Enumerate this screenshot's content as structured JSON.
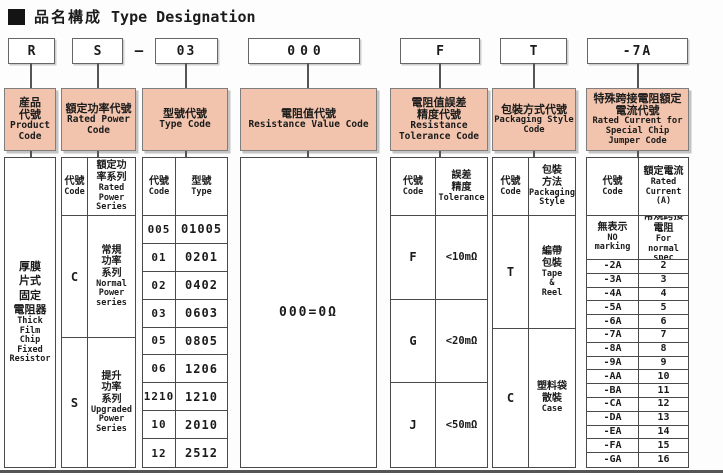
{
  "title": {
    "zh": "品名構成",
    "en": "Type Designation",
    "bullet_icon": "filled-square"
  },
  "codes": {
    "product": "R",
    "power": "S",
    "separator": "—",
    "type": "03",
    "resistance": "000",
    "tolerance": "F",
    "packaging": "T",
    "current": "-7A"
  },
  "headers": [
    {
      "zh": "産品\n代號",
      "en": "Product\nCode"
    },
    {
      "zh": "額定功率代號",
      "en": "Rated Power\nCode"
    },
    {
      "zh": "型號代號",
      "en": "Type Code"
    },
    {
      "zh": "電阻值代號",
      "en": "Resistance Value Code"
    },
    {
      "zh": "電阻值誤差\n精度代號",
      "en": "Resistance\nTolerance Code"
    },
    {
      "zh": "包裝方式代號",
      "en": "Packaging Style\nCode"
    },
    {
      "zh": "特殊跨接電阻額定\n電流代號",
      "en": "Rated Current for\nSpecial Chip\nJumper Code"
    }
  ],
  "product": {
    "body_zh": "厚膜\n片式\n固定\n電阻器",
    "body_en": "Thick\nFilm\nChip\nFixed\nResistor"
  },
  "power": {
    "sub_code_zh": "代號",
    "sub_code_en": "Code",
    "sub_series_zh": "額定功\n率系列",
    "sub_series_en": "Rated\nPower\nSeries",
    "rows": [
      {
        "code": "C",
        "zh": "常規\n功率\n系列",
        "en": "Normal\nPower\nseries"
      },
      {
        "code": "S",
        "zh": "提升\n功率\n系列",
        "en": "Upgraded\nPower\nSeries"
      }
    ]
  },
  "type": {
    "sub_code_zh": "代號",
    "sub_code_en": "Code",
    "sub_type_zh": "型號",
    "sub_type_en": "Type",
    "rows": [
      [
        "005",
        "01005"
      ],
      [
        "01",
        "0201"
      ],
      [
        "02",
        "0402"
      ],
      [
        "03",
        "0603"
      ],
      [
        "05",
        "0805"
      ],
      [
        "06",
        "1206"
      ],
      [
        "1210",
        "1210"
      ],
      [
        "10",
        "2010"
      ],
      [
        "12",
        "2512"
      ]
    ]
  },
  "resistance": {
    "body": "000=0Ω"
  },
  "tolerance": {
    "sub_code_zh": "代號",
    "sub_code_en": "Code",
    "sub_tol_zh": "誤差\n精度",
    "sub_tol_en": "Tolerance",
    "rows": [
      [
        "F",
        "<10mΩ"
      ],
      [
        "G",
        "<20mΩ"
      ],
      [
        "J",
        "<50mΩ"
      ]
    ]
  },
  "packaging": {
    "sub_code_zh": "代號",
    "sub_code_en": "Code",
    "sub_style_zh": "包裝\n方法",
    "sub_style_en": "Packaging\nStyle",
    "rows": [
      {
        "code": "T",
        "zh": "編帶\n包裝",
        "en": "Tape\n&\nReel"
      },
      {
        "code": "C",
        "zh": "塑料袋\n散裝",
        "en": "Case"
      }
    ]
  },
  "current": {
    "sub_code_zh": "代號",
    "sub_code_en": "Code",
    "sub_cur_zh": "額定電流",
    "sub_cur_en": "Rated\nCurrent\n(A)",
    "special": {
      "code_zh": "無表示",
      "code_en": "NO\nmarking",
      "val_zh": "常規跨接\n電阻",
      "val_en": "For normal\nspec"
    },
    "rows": [
      [
        "-2A",
        "2"
      ],
      [
        "-3A",
        "3"
      ],
      [
        "-4A",
        "4"
      ],
      [
        "-5A",
        "5"
      ],
      [
        "-6A",
        "6"
      ],
      [
        "-7A",
        "7"
      ],
      [
        "-8A",
        "8"
      ],
      [
        "-9A",
        "9"
      ],
      [
        "-AA",
        "10"
      ],
      [
        "-BA",
        "11"
      ],
      [
        "-CA",
        "12"
      ],
      [
        "-DA",
        "13"
      ],
      [
        "-EA",
        "14"
      ],
      [
        "-FA",
        "15"
      ],
      [
        "-GA",
        "16"
      ]
    ]
  },
  "colors": {
    "header_fill": "#f2c4ad",
    "line_color": "#4a4a4a",
    "header_border": "#7e7e7e",
    "text": "#1b1b1b"
  }
}
